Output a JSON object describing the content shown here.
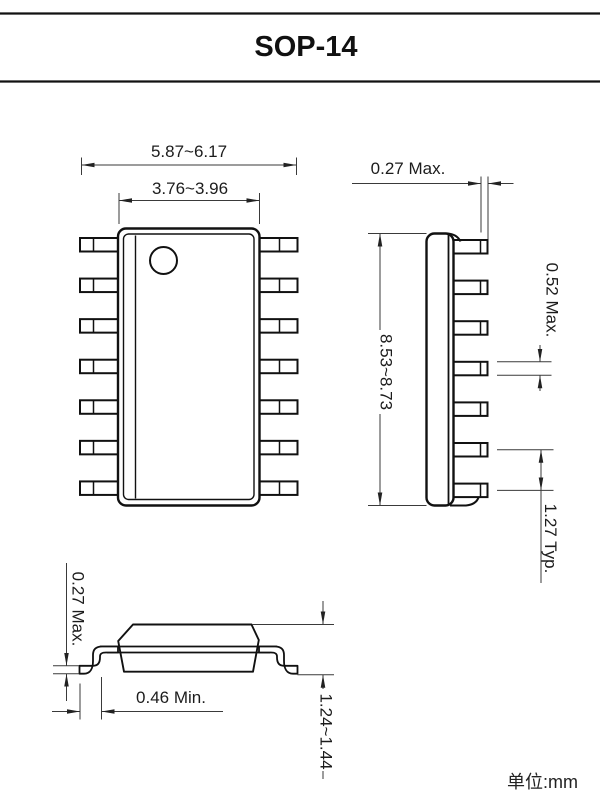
{
  "title": "SOP-14",
  "unit_note": "单位:mm",
  "package": {
    "pins_per_side": 7,
    "total_pins": 14
  },
  "top_view": {
    "overall_width": "5.87~6.17",
    "body_width": "3.76~3.96"
  },
  "side_view": {
    "lead_tip_thickness": "0.27 Max.",
    "body_length": "8.53~8.73",
    "lead_width": "0.52 Max.",
    "lead_pitch": "1.27 Typ."
  },
  "end_view": {
    "lead_foot_thickness": "0.27 Max.",
    "foot_length": "0.46 Min.",
    "overall_height": "1.24~1.44"
  },
  "colors": {
    "line": "#111111",
    "dim_line": "#3a3a3a",
    "background": "#ffffff"
  }
}
